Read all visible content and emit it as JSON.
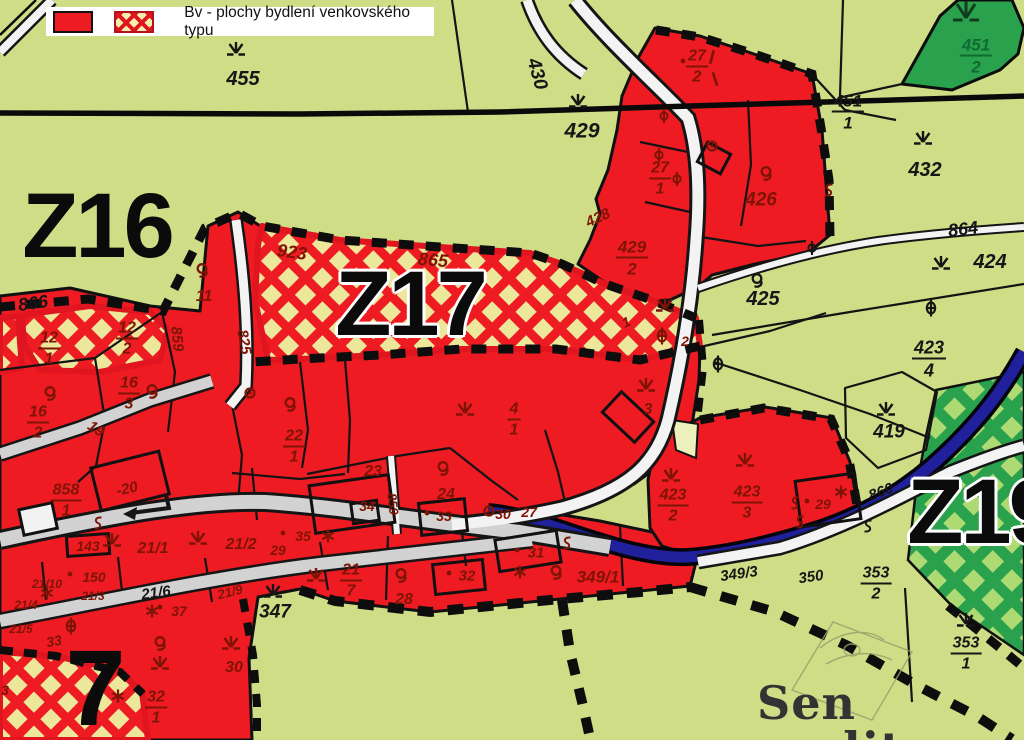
{
  "legend": {
    "label": "Bv - plochy bydlení venkovského typu",
    "solid_swatch": "red-solid-zone",
    "hatch_swatch": "red-crosshatch-zone"
  },
  "watermark": {
    "text": "Sen reality"
  },
  "colors": {
    "g": "#161616",
    "m": "#7e1405",
    "gr": "#0e6b31",
    "dg": "#123c1f"
  },
  "zones": [
    {
      "label": "Z16",
      "x": 97,
      "y": 226,
      "size": 92,
      "halo": false
    },
    {
      "label": "Z17",
      "x": 410,
      "y": 304,
      "size": 92,
      "halo": true
    },
    {
      "label": "Z19",
      "x": 982,
      "y": 512,
      "size": 92,
      "halo": true
    },
    {
      "label": "7",
      "x": 94,
      "y": 688,
      "size": 108,
      "halo": false
    }
  ],
  "parcels": [
    {
      "t": "455",
      "x": 243,
      "y": 79,
      "s": 20,
      "c": "g"
    },
    {
      "t": "429",
      "x": 582,
      "y": 131,
      "s": 21,
      "c": "g"
    },
    {
      "t": "430",
      "x": 537,
      "y": 74,
      "s": 19,
      "c": "g",
      "r": 74
    },
    {
      "t": "432",
      "x": 925,
      "y": 170,
      "s": 20,
      "c": "g"
    },
    {
      "t": "864",
      "x": 963,
      "y": 229,
      "s": 18,
      "c": "g",
      "r": -7
    },
    {
      "t": "424",
      "x": 990,
      "y": 262,
      "s": 20,
      "c": "g"
    },
    {
      "n": "451",
      "d": "1",
      "x": 848,
      "y": 112,
      "s": 17,
      "c": "g"
    },
    {
      "n": "451",
      "d": "2",
      "x": 976,
      "y": 56,
      "s": 17,
      "c": "gr"
    },
    {
      "t": "425",
      "x": 763,
      "y": 299,
      "s": 20,
      "c": "g"
    },
    {
      "n": "423",
      "d": "4",
      "x": 929,
      "y": 359,
      "s": 18,
      "c": "g"
    },
    {
      "t": "419",
      "x": 889,
      "y": 432,
      "s": 19,
      "c": "g"
    },
    {
      "t": "426",
      "x": 761,
      "y": 200,
      "s": 19,
      "c": "m"
    },
    {
      "n": "429",
      "d": "2",
      "x": 632,
      "y": 258,
      "s": 17,
      "c": "m"
    },
    {
      "n": "27",
      "d": "2",
      "x": 697,
      "y": 67,
      "s": 16,
      "c": "m"
    },
    {
      "n": "27",
      "d": "1",
      "x": 660,
      "y": 179,
      "s": 16,
      "c": "m"
    },
    {
      "t": "428",
      "x": 598,
      "y": 218,
      "s": 15,
      "c": "m",
      "r": -25
    },
    {
      "t": "923",
      "x": 292,
      "y": 252,
      "s": 18,
      "c": "m",
      "r": 8
    },
    {
      "t": "865",
      "x": 433,
      "y": 260,
      "s": 18,
      "c": "m",
      "r": 5
    },
    {
      "t": "866",
      "x": 33,
      "y": 303,
      "s": 18,
      "c": "g",
      "r": -8
    },
    {
      "t": "825",
      "x": 244,
      "y": 342,
      "s": 15,
      "c": "m",
      "r": 80
    },
    {
      "t": "859",
      "x": 177,
      "y": 339,
      "s": 15,
      "c": "m",
      "r": 84
    },
    {
      "n": "12",
      "d": "1",
      "x": 49,
      "y": 349,
      "s": 16,
      "c": "m"
    },
    {
      "n": "12",
      "d": "2",
      "x": 127,
      "y": 339,
      "s": 16,
      "c": "m"
    },
    {
      "t": "11",
      "x": 204,
      "y": 297,
      "s": 16,
      "c": "m"
    },
    {
      "n": "16",
      "d": "3",
      "x": 129,
      "y": 394,
      "s": 16,
      "c": "m"
    },
    {
      "n": "16",
      "d": "2",
      "x": 38,
      "y": 423,
      "s": 16,
      "c": "m"
    },
    {
      "t": "19",
      "x": 96,
      "y": 429,
      "s": 15,
      "c": "m",
      "r": 33
    },
    {
      "n": "858",
      "d": "1",
      "x": 66,
      "y": 501,
      "s": 16,
      "c": "m"
    },
    {
      "t": "-20",
      "x": 127,
      "y": 489,
      "s": 15,
      "c": "m",
      "r": -13
    },
    {
      "n": "22",
      "d": "1",
      "x": 294,
      "y": 447,
      "s": 16,
      "c": "m"
    },
    {
      "n": "4",
      "d": "1",
      "x": 514,
      "y": 420,
      "s": 16,
      "c": "m"
    },
    {
      "t": "3",
      "x": 648,
      "y": 410,
      "s": 16,
      "c": "m"
    },
    {
      "t": "23",
      "x": 373,
      "y": 472,
      "s": 16,
      "c": "m"
    },
    {
      "t": "24",
      "x": 446,
      "y": 495,
      "s": 16,
      "c": "m"
    },
    {
      "t": "34",
      "x": 367,
      "y": 506,
      "s": 14,
      "c": "m"
    },
    {
      "t": "859",
      "x": 393,
      "y": 504,
      "s": 13,
      "c": "m",
      "r": 84
    },
    {
      "t": "33",
      "x": 444,
      "y": 516,
      "s": 14,
      "c": "m"
    },
    {
      "t": "30",
      "x": 503,
      "y": 514,
      "s": 14,
      "c": "m"
    },
    {
      "t": "27",
      "x": 529,
      "y": 512,
      "s": 14,
      "c": "m"
    },
    {
      "t": "143",
      "x": 88,
      "y": 546,
      "s": 14,
      "c": "m"
    },
    {
      "t": "150",
      "x": 94,
      "y": 577,
      "s": 14,
      "c": "m"
    },
    {
      "t": "21/1",
      "x": 153,
      "y": 549,
      "s": 16,
      "c": "m"
    },
    {
      "t": "21/2",
      "x": 241,
      "y": 545,
      "s": 16,
      "c": "m"
    },
    {
      "t": "29",
      "x": 278,
      "y": 550,
      "s": 14,
      "c": "m"
    },
    {
      "t": "35",
      "x": 303,
      "y": 536,
      "s": 14,
      "c": "m"
    },
    {
      "t": "21/6",
      "x": 156,
      "y": 593,
      "s": 15,
      "c": "g",
      "r": -8
    },
    {
      "t": "21/9",
      "x": 230,
      "y": 592,
      "s": 13,
      "c": "m",
      "r": -14
    },
    {
      "t": "21/10",
      "x": 47,
      "y": 584,
      "s": 12,
      "c": "m"
    },
    {
      "t": "21/3",
      "x": 93,
      "y": 596,
      "s": 12,
      "c": "m"
    },
    {
      "t": "21/4",
      "x": 26,
      "y": 605,
      "s": 12,
      "c": "m"
    },
    {
      "t": "21/5",
      "x": 21,
      "y": 629,
      "s": 12,
      "c": "m"
    },
    {
      "t": "37",
      "x": 179,
      "y": 611,
      "s": 14,
      "c": "m"
    },
    {
      "t": "33",
      "x": 54,
      "y": 641,
      "s": 14,
      "c": "m",
      "r": -10
    },
    {
      "n": "21",
      "d": "7",
      "x": 351,
      "y": 581,
      "s": 16,
      "c": "m"
    },
    {
      "t": "28",
      "x": 404,
      "y": 600,
      "s": 16,
      "c": "m"
    },
    {
      "t": "347",
      "x": 275,
      "y": 612,
      "s": 19,
      "c": "g"
    },
    {
      "t": "31",
      "x": 536,
      "y": 553,
      "s": 15,
      "c": "m"
    },
    {
      "t": "32",
      "x": 467,
      "y": 576,
      "s": 15,
      "c": "m"
    },
    {
      "t": "349/1",
      "x": 598,
      "y": 577,
      "s": 17,
      "c": "m"
    },
    {
      "n": "32",
      "d": "1",
      "x": 156,
      "y": 708,
      "s": 16,
      "c": "m"
    },
    {
      "t": "30",
      "x": 234,
      "y": 668,
      "s": 16,
      "c": "m"
    },
    {
      "n": "423",
      "d": "2",
      "x": 673,
      "y": 506,
      "s": 16,
      "c": "m"
    },
    {
      "n": "423",
      "d": "3",
      "x": 747,
      "y": 503,
      "s": 16,
      "c": "m"
    },
    {
      "t": "29",
      "x": 823,
      "y": 504,
      "s": 14,
      "c": "m"
    },
    {
      "t": "349/3",
      "x": 739,
      "y": 574,
      "s": 15,
      "c": "g",
      "r": -8
    },
    {
      "t": "350",
      "x": 811,
      "y": 577,
      "s": 15,
      "c": "g",
      "r": -8
    },
    {
      "n": "353",
      "d": "2",
      "x": 876,
      "y": 584,
      "s": 16,
      "c": "g"
    },
    {
      "n": "353",
      "d": "1",
      "x": 966,
      "y": 654,
      "s": 16,
      "c": "g"
    },
    {
      "t": "860",
      "x": 881,
      "y": 492,
      "s": 15,
      "c": "g",
      "r": -21
    },
    {
      "t": "1",
      "x": 626,
      "y": 322,
      "s": 14,
      "c": "m",
      "r": -25
    },
    {
      "t": "2",
      "x": 685,
      "y": 341,
      "s": 14,
      "c": "m"
    },
    {
      "t": "3",
      "x": 5,
      "y": 690,
      "s": 14,
      "c": "m"
    }
  ],
  "symbols": [
    {
      "type": "grass",
      "x": 236,
      "y": 50,
      "c": "g"
    },
    {
      "type": "grass",
      "x": 578,
      "y": 102,
      "c": "g"
    },
    {
      "type": "grass",
      "x": 923,
      "y": 139,
      "c": "g"
    },
    {
      "type": "grass",
      "x": 941,
      "y": 264,
      "c": "g"
    },
    {
      "type": "grass",
      "x": 886,
      "y": 410,
      "c": "g"
    },
    {
      "type": "grass",
      "x": 966,
      "y": 621,
      "c": "g"
    },
    {
      "type": "grass",
      "x": 273,
      "y": 592,
      "c": "g"
    },
    {
      "type": "grass",
      "x": 665,
      "y": 306,
      "c": "m"
    },
    {
      "type": "grass",
      "x": 465,
      "y": 410,
      "c": "m"
    },
    {
      "type": "grass",
      "x": 646,
      "y": 386,
      "c": "m"
    },
    {
      "type": "grass",
      "x": 671,
      "y": 476,
      "c": "m"
    },
    {
      "type": "grass",
      "x": 745,
      "y": 461,
      "c": "m"
    },
    {
      "type": "grass",
      "x": 316,
      "y": 576,
      "c": "m"
    },
    {
      "type": "grass",
      "x": 112,
      "y": 541,
      "c": "m"
    },
    {
      "type": "grass",
      "x": 198,
      "y": 539,
      "c": "m"
    },
    {
      "type": "grass",
      "x": 231,
      "y": 644,
      "c": "m"
    },
    {
      "type": "grass",
      "x": 160,
      "y": 664,
      "c": "m"
    },
    {
      "type": "orchard",
      "x": 202,
      "y": 271,
      "c": "m"
    },
    {
      "type": "orchard",
      "x": 290,
      "y": 405,
      "c": "m"
    },
    {
      "type": "orchard",
      "x": 443,
      "y": 469,
      "c": "m"
    },
    {
      "type": "orchard",
      "x": 401,
      "y": 576,
      "c": "m"
    },
    {
      "type": "orchard",
      "x": 556,
      "y": 573,
      "c": "m"
    },
    {
      "type": "orchard",
      "x": 757,
      "y": 281,
      "c": "g"
    },
    {
      "type": "orchard",
      "x": 766,
      "y": 174,
      "c": "m"
    },
    {
      "type": "orchard",
      "x": 50,
      "y": 394,
      "c": "m"
    },
    {
      "type": "orchard",
      "x": 160,
      "y": 644,
      "c": "m"
    },
    {
      "type": "orchard",
      "x": 152,
      "y": 392,
      "c": "m"
    },
    {
      "type": "theta",
      "x": 931,
      "y": 308,
      "c": "g"
    },
    {
      "type": "theta",
      "x": 718,
      "y": 364,
      "c": "g"
    },
    {
      "type": "theta",
      "x": 71,
      "y": 626,
      "c": "m"
    },
    {
      "type": "theta",
      "x": 662,
      "y": 336,
      "c": "m"
    },
    {
      "type": "phi",
      "x": 664,
      "y": 116,
      "c": "m"
    },
    {
      "type": "phi",
      "x": 659,
      "y": 155,
      "c": "m"
    },
    {
      "type": "phi",
      "x": 677,
      "y": 179,
      "c": "m"
    },
    {
      "type": "phi",
      "x": 812,
      "y": 248,
      "c": "g"
    },
    {
      "type": "star",
      "x": 328,
      "y": 536,
      "c": "m"
    },
    {
      "type": "star",
      "x": 152,
      "y": 611,
      "c": "m"
    },
    {
      "type": "star",
      "x": 520,
      "y": 572,
      "c": "m"
    },
    {
      "type": "star",
      "x": 841,
      "y": 492,
      "c": "m"
    },
    {
      "type": "star",
      "x": 47,
      "y": 593,
      "c": "m"
    },
    {
      "type": "star",
      "x": 118,
      "y": 696,
      "c": "m"
    },
    {
      "type": "scurve",
      "x": 829,
      "y": 190,
      "c": "m"
    },
    {
      "type": "scurve",
      "x": 795,
      "y": 503,
      "c": "m"
    },
    {
      "type": "scurve",
      "x": 800,
      "y": 522,
      "c": "m"
    },
    {
      "type": "scurve",
      "x": 868,
      "y": 526,
      "c": "g"
    },
    {
      "type": "scurve",
      "x": 567,
      "y": 543,
      "c": "m"
    },
    {
      "type": "scurve",
      "x": 98,
      "y": 523,
      "c": "m"
    },
    {
      "type": "circledot",
      "x": 489,
      "y": 511,
      "c": "m"
    },
    {
      "type": "circledot",
      "x": 250,
      "y": 393,
      "c": "m"
    },
    {
      "type": "circledot",
      "x": 712,
      "y": 146,
      "c": "m"
    },
    {
      "type": "tick",
      "x": 712,
      "y": 57,
      "c": "m",
      "r": 15
    },
    {
      "type": "tick",
      "x": 715,
      "y": 79,
      "c": "m",
      "r": -18
    },
    {
      "type": "dot",
      "x": 683,
      "y": 61,
      "c": "m"
    },
    {
      "type": "dot",
      "x": 70,
      "y": 574,
      "c": "m"
    },
    {
      "type": "dot",
      "x": 283,
      "y": 533,
      "c": "m"
    },
    {
      "type": "dot",
      "x": 160,
      "y": 607,
      "c": "m"
    },
    {
      "type": "dot",
      "x": 517,
      "y": 550,
      "c": "m"
    },
    {
      "type": "dot",
      "x": 449,
      "y": 573,
      "c": "m"
    },
    {
      "type": "dot",
      "x": 427,
      "y": 513,
      "c": "m"
    },
    {
      "type": "dot",
      "x": 807,
      "y": 501,
      "c": "m"
    },
    {
      "type": "forest",
      "x": 966,
      "y": 13,
      "c": "dg"
    },
    {
      "type": "arrow",
      "x": 143,
      "y": 505,
      "c": "g"
    }
  ]
}
